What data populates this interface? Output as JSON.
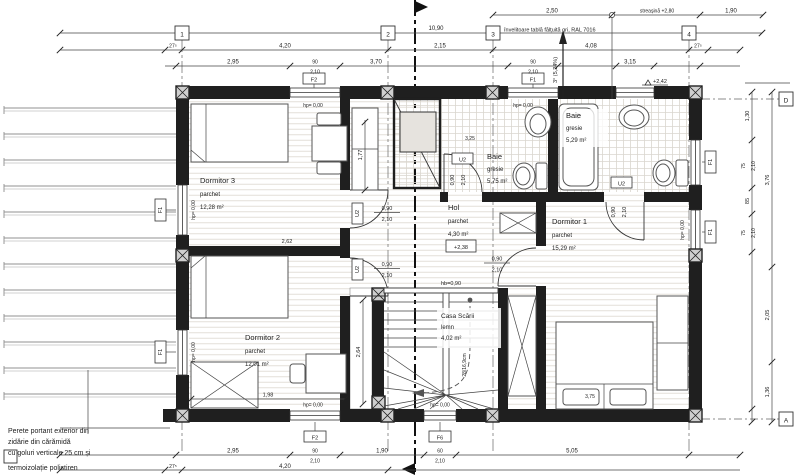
{
  "drawing": {
    "roof_note": "învelitoare tablă fălțuită gri, RAL 7016",
    "slope": "3° (5,24%)",
    "eave": "streașină +2,80",
    "level_attic": "+2,42",
    "wall_note_1": "Perete portant exterior din",
    "wall_note_2": "zidărie din cărămidă",
    "wall_note_3": "cu goluri verticale 25 cm și",
    "wall_note_4": "termoizolație polistiren"
  },
  "grid": {
    "c1": "1",
    "c2": "2",
    "c3": "3",
    "c4": "4",
    "rD": "D",
    "rA": "A"
  },
  "rooms": {
    "dormitor3": {
      "name": "Dormitor 3",
      "finish": "parchet",
      "area": "12,28 m²"
    },
    "dormitor2": {
      "name": "Dormitor 2",
      "finish": "parchet",
      "area": "12,01 m²"
    },
    "dormitor1": {
      "name": "Dormitor 1",
      "finish": "parchet",
      "area": "15,29 m²"
    },
    "baie1": {
      "name": "Baie",
      "finish": "gresie",
      "area": "5,75 m²"
    },
    "baie2": {
      "name": "Baie",
      "finish": "gresie",
      "area": "5,29 m²"
    },
    "hol": {
      "name": "Hol",
      "finish": "parchet",
      "area": "4,30 m²",
      "level": "+2,38"
    },
    "scara": {
      "name": "Casa Scării",
      "finish": "lemn",
      "area": "4,02 m²",
      "parapet": "hb=0,90",
      "step": "28/16,9cm"
    }
  },
  "tags": {
    "door": "U2",
    "f1": "F1",
    "f2": "F2",
    "f6": "F6",
    "sill": "hp= 0,00"
  },
  "door": {
    "w": "0,90",
    "h": "2,10"
  },
  "dims": {
    "total_top": "10,90",
    "t1a": "2,50",
    "t1b": "1,90",
    "t2a": "27⁵",
    "t2b": "4,20",
    "t2c": "2,15",
    "t2d": "4,08",
    "t2e": "27⁵",
    "t3a": "2,95",
    "t3w1": "90",
    "t3w1h": "2,10",
    "t3b": "3,70",
    "t3w2": "90",
    "t3w2h": "2,10",
    "t3c": "3,15",
    "b1a": "2,95",
    "b1w1": "90",
    "b1w1h": "2,10",
    "b1b": "1,90",
    "b1w2": "60",
    "b1w2h": "2,10",
    "b1c": "5,05",
    "b2a": "27⁵",
    "b2b": "4,20",
    "r1": "1,30",
    "r2": "75",
    "r2h": "2,10",
    "r3": "85",
    "r4": "75",
    "r4h": "2,10",
    "r5": "3,76",
    "r6": "2,05",
    "r7": "1,36",
    "i1": "2,62",
    "i2": "1,77",
    "i3": "2,64",
    "i4": "1,98",
    "i5": "3,25",
    "i6": "3,75"
  }
}
